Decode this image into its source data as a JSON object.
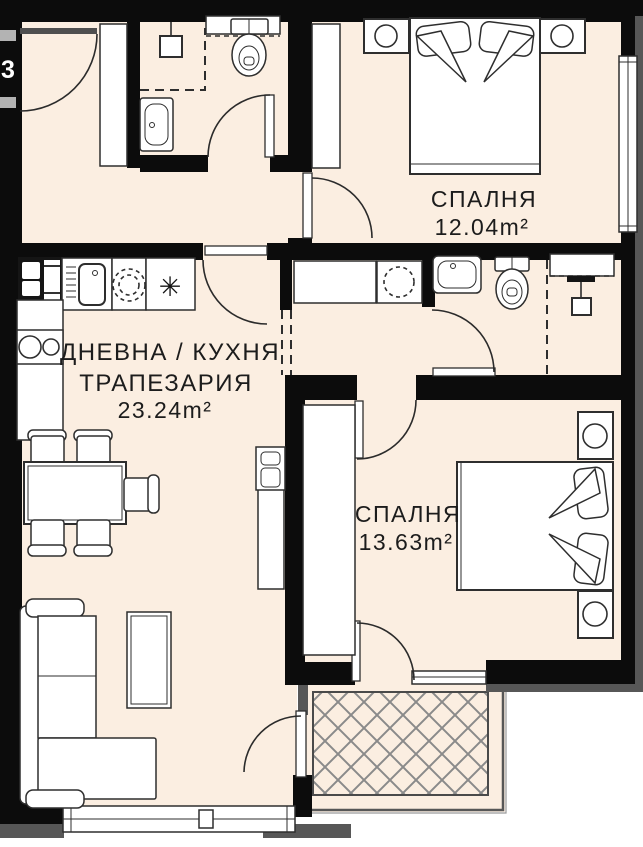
{
  "unit_number": "3",
  "rooms": {
    "bedroom1": {
      "name": "СПАЛНЯ",
      "area": "12.04m²"
    },
    "living": {
      "name_line1": "ДНЕВНА / КУХНЯ",
      "name_line2": "ТРАПЕЗАРИЯ",
      "area": "23.24m²"
    },
    "bedroom2": {
      "name": "СПАЛНЯ",
      "area": "13.63m²"
    }
  },
  "symbols": {
    "freezer": "✳"
  },
  "fixtures": [
    "entrance-door",
    "wardrobe",
    "shower",
    "washbasin",
    "toilet",
    "shelf",
    "fridge",
    "kitchen-sink",
    "hob",
    "freezer",
    "washing-machine",
    "dining-table",
    "chair",
    "sofa",
    "coffee-table",
    "tv-cabinet",
    "double-bed",
    "nightstand",
    "terrace"
  ],
  "colors": {
    "floor": "#fbeee1",
    "wall": "#0c0c0c",
    "trim": "#575757",
    "line": "#2e2e2e",
    "hatch": "#8a8a8a",
    "label": "#1c1c1c"
  }
}
